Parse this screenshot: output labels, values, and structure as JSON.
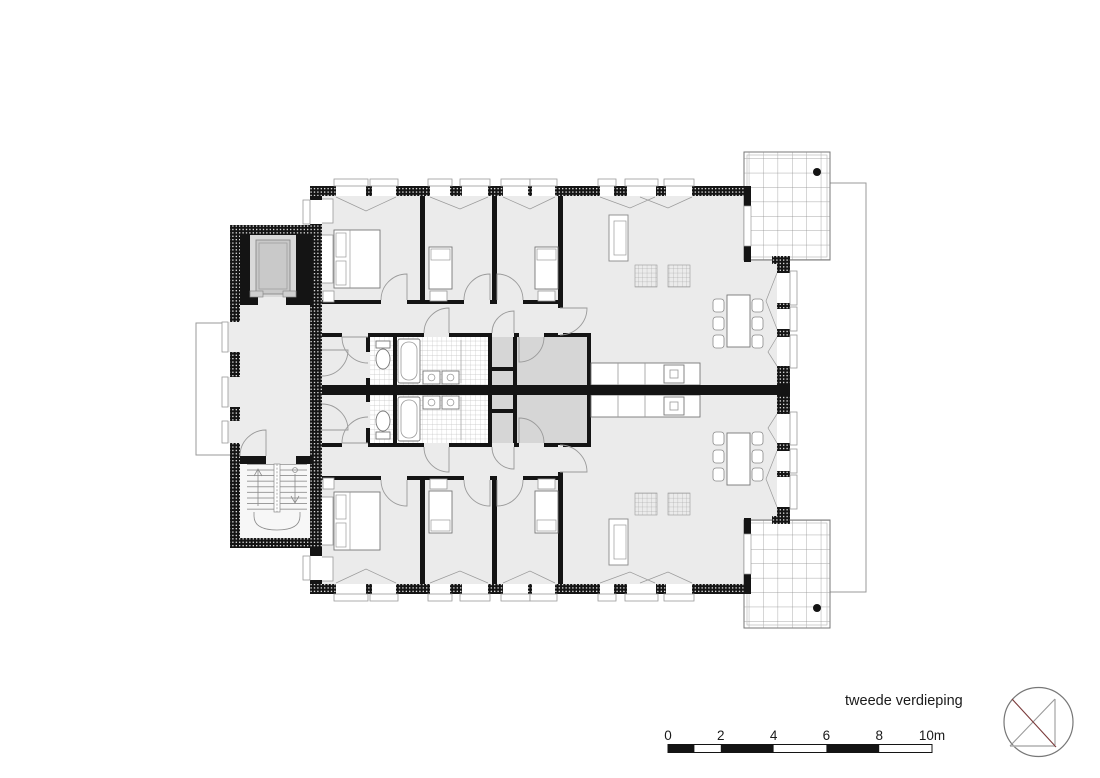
{
  "drawing": {
    "caption": "tweede verdieping",
    "type": "architectural-floor-plan"
  },
  "scale_bar": {
    "tick_labels": [
      "0",
      "2",
      "4",
      "6",
      "8",
      "10m"
    ],
    "meters_total": 10,
    "filled_segments_m": [
      [
        0,
        1
      ],
      [
        2,
        4
      ],
      [
        6,
        8
      ]
    ]
  },
  "north_arrow": {
    "icon": "circle-with-diagonals-icon"
  },
  "colors": {
    "paper": "#ffffff",
    "room_fill": "#ebebeb",
    "storage_fill": "#d6d6d6",
    "elevator_car_fill": "#c9c9c9",
    "wall": "#141414",
    "thin_line": "#8a8a8a",
    "north_arrow_red": "#7a3a3a"
  }
}
